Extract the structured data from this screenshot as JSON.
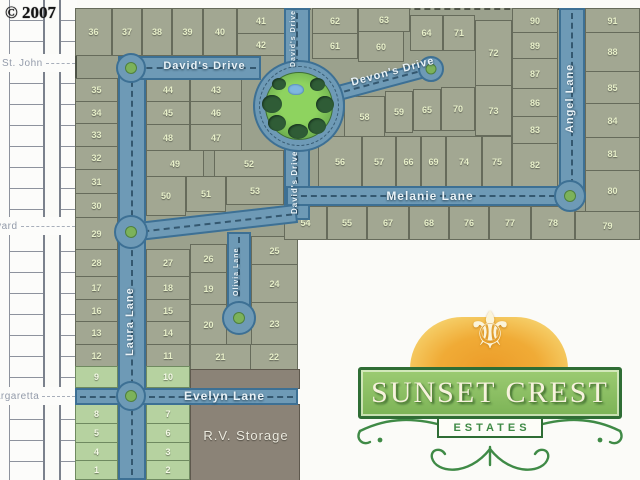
{
  "copyright": "© 2007",
  "logo": {
    "title": "SUNSET CREST",
    "subtitle": "ESTATES"
  },
  "map": {
    "rv_storage": "R.V. Storage",
    "offsite_streets": [
      {
        "name": "St. John",
        "x": 2,
        "y": 63
      },
      {
        "name": "Boulevard",
        "x": -32,
        "y": 226
      },
      {
        "name": "Margaretta",
        "x": -14,
        "y": 396
      }
    ],
    "street_labels": [
      {
        "text": "David's Drive",
        "kind": "h",
        "x": 152,
        "y": 60,
        "w": 105,
        "size": 11
      },
      {
        "text": "David's Drive",
        "kind": "v",
        "x": 290,
        "y": 10,
        "h": 56,
        "size": 7
      },
      {
        "text": "David's Drive",
        "kind": "v",
        "x": 290,
        "y": 146,
        "h": 72,
        "size": 8
      },
      {
        "text": "Devon's Drive",
        "kind": "r",
        "x": 347,
        "y": 78,
        "w": 95,
        "size": 11,
        "deg": -15
      },
      {
        "text": "Melanie Lane",
        "kind": "h",
        "x": 340,
        "y": 189,
        "w": 180,
        "size": 12
      },
      {
        "text": "Angel Lane",
        "kind": "v",
        "x": 564,
        "y": 48,
        "h": 100,
        "size": 11
      },
      {
        "text": "Laura Lane",
        "kind": "v",
        "x": 124,
        "y": 268,
        "h": 108,
        "size": 11
      },
      {
        "text": "Olivia Lane",
        "kind": "v",
        "x": 233,
        "y": 241,
        "h": 62,
        "size": 7
      },
      {
        "text": "Evelyn Lane",
        "kind": "h",
        "x": 162,
        "y": 389,
        "w": 125,
        "size": 12
      }
    ],
    "lots": [
      {
        "n": "36",
        "x": 75,
        "y": 8,
        "w": 37,
        "h": 48
      },
      {
        "n": "37",
        "x": 112,
        "y": 8,
        "w": 30,
        "h": 48
      },
      {
        "n": "38",
        "x": 142,
        "y": 8,
        "w": 30,
        "h": 48
      },
      {
        "n": "39",
        "x": 172,
        "y": 8,
        "w": 31,
        "h": 48
      },
      {
        "n": "40",
        "x": 203,
        "y": 8,
        "w": 34,
        "h": 48
      },
      {
        "n": "41",
        "x": 237,
        "y": 8,
        "w": 48,
        "h": 26
      },
      {
        "n": "42",
        "x": 237,
        "y": 33,
        "w": 48,
        "h": 23
      },
      {
        "n": "35",
        "x": 75,
        "y": 78,
        "w": 43,
        "h": 24
      },
      {
        "n": "34",
        "x": 75,
        "y": 101,
        "w": 43,
        "h": 23
      },
      {
        "n": "33",
        "x": 75,
        "y": 123,
        "w": 43,
        "h": 24
      },
      {
        "n": "32",
        "x": 75,
        "y": 146,
        "w": 43,
        "h": 24
      },
      {
        "n": "31",
        "x": 75,
        "y": 169,
        "w": 43,
        "h": 25
      },
      {
        "n": "30",
        "x": 75,
        "y": 193,
        "w": 43,
        "h": 25
      },
      {
        "n": "29",
        "x": 75,
        "y": 217,
        "w": 43,
        "h": 33
      },
      {
        "n": "28",
        "x": 75,
        "y": 249,
        "w": 43,
        "h": 28
      },
      {
        "n": "17",
        "x": 75,
        "y": 276,
        "w": 43,
        "h": 24
      },
      {
        "n": "16",
        "x": 75,
        "y": 299,
        "w": 43,
        "h": 23
      },
      {
        "n": "13",
        "x": 75,
        "y": 321,
        "w": 43,
        "h": 24
      },
      {
        "n": "12",
        "x": 75,
        "y": 344,
        "w": 43,
        "h": 23
      },
      {
        "n": "9",
        "x": 75,
        "y": 366,
        "w": 43,
        "h": 22,
        "g": true
      },
      {
        "n": "8",
        "x": 75,
        "y": 403,
        "w": 43,
        "h": 21,
        "g": true
      },
      {
        "n": "5",
        "x": 75,
        "y": 423,
        "w": 43,
        "h": 20,
        "g": true
      },
      {
        "n": "4",
        "x": 75,
        "y": 442,
        "w": 43,
        "h": 19,
        "g": true
      },
      {
        "n": "1",
        "x": 75,
        "y": 460,
        "w": 43,
        "h": 20,
        "g": true
      },
      {
        "n": "27",
        "x": 146,
        "y": 249,
        "w": 44,
        "h": 28
      },
      {
        "n": "18",
        "x": 146,
        "y": 276,
        "w": 44,
        "h": 24
      },
      {
        "n": "15",
        "x": 146,
        "y": 299,
        "w": 44,
        "h": 23
      },
      {
        "n": "14",
        "x": 146,
        "y": 321,
        "w": 44,
        "h": 24
      },
      {
        "n": "11",
        "x": 146,
        "y": 344,
        "w": 44,
        "h": 23
      },
      {
        "n": "10",
        "x": 146,
        "y": 366,
        "w": 44,
        "h": 22,
        "g": true
      },
      {
        "n": "7",
        "x": 146,
        "y": 403,
        "w": 44,
        "h": 21,
        "g": true
      },
      {
        "n": "6",
        "x": 146,
        "y": 423,
        "w": 44,
        "h": 20,
        "g": true
      },
      {
        "n": "3",
        "x": 146,
        "y": 442,
        "w": 44,
        "h": 19,
        "g": true
      },
      {
        "n": "2",
        "x": 146,
        "y": 460,
        "w": 44,
        "h": 20,
        "g": true
      },
      {
        "n": "26",
        "x": 190,
        "y": 244,
        "w": 37,
        "h": 29
      },
      {
        "n": "19",
        "x": 190,
        "y": 272,
        "w": 37,
        "h": 33
      },
      {
        "n": "20",
        "x": 190,
        "y": 304,
        "w": 37,
        "h": 41
      },
      {
        "n": "21",
        "x": 190,
        "y": 344,
        "w": 61,
        "h": 26
      },
      {
        "n": "25",
        "x": 251,
        "y": 236,
        "w": 47,
        "h": 29
      },
      {
        "n": "24",
        "x": 251,
        "y": 264,
        "w": 47,
        "h": 39
      },
      {
        "n": "23",
        "x": 251,
        "y": 302,
        "w": 47,
        "h": 43
      },
      {
        "n": "22",
        "x": 250,
        "y": 344,
        "w": 48,
        "h": 26
      },
      {
        "n": "44",
        "x": 146,
        "y": 78,
        "w": 44,
        "h": 24
      },
      {
        "n": "43",
        "x": 190,
        "y": 78,
        "w": 52,
        "h": 24
      },
      {
        "n": "45",
        "x": 146,
        "y": 101,
        "w": 44,
        "h": 24
      },
      {
        "n": "46",
        "x": 190,
        "y": 101,
        "w": 52,
        "h": 24
      },
      {
        "n": "48",
        "x": 146,
        "y": 124,
        "w": 44,
        "h": 27
      },
      {
        "n": "47",
        "x": 190,
        "y": 124,
        "w": 52,
        "h": 27
      },
      {
        "n": "49",
        "x": 146,
        "y": 150,
        "w": 58,
        "h": 27
      },
      {
        "n": "52",
        "x": 214,
        "y": 150,
        "w": 70,
        "h": 27
      },
      {
        "n": "50",
        "x": 146,
        "y": 176,
        "w": 40,
        "h": 40
      },
      {
        "n": "51",
        "x": 186,
        "y": 176,
        "w": 40,
        "h": 36
      },
      {
        "n": "53",
        "x": 226,
        "y": 176,
        "w": 58,
        "h": 29
      },
      {
        "n": "62",
        "x": 312,
        "y": 8,
        "w": 46,
        "h": 26
      },
      {
        "n": "63",
        "x": 358,
        "y": 8,
        "w": 52,
        "h": 24
      },
      {
        "n": "61",
        "x": 312,
        "y": 33,
        "w": 46,
        "h": 26
      },
      {
        "n": "60",
        "x": 358,
        "y": 31,
        "w": 46,
        "h": 31
      },
      {
        "n": "64",
        "x": 410,
        "y": 15,
        "w": 33,
        "h": 36
      },
      {
        "n": "71",
        "x": 443,
        "y": 15,
        "w": 32,
        "h": 36
      },
      {
        "n": "72",
        "x": 475,
        "y": 20,
        "w": 37,
        "h": 66
      },
      {
        "n": "73",
        "x": 475,
        "y": 85,
        "w": 37,
        "h": 51
      },
      {
        "n": "58",
        "x": 344,
        "y": 96,
        "w": 41,
        "h": 41
      },
      {
        "n": "59",
        "x": 385,
        "y": 91,
        "w": 28,
        "h": 42
      },
      {
        "n": "65",
        "x": 413,
        "y": 89,
        "w": 28,
        "h": 42
      },
      {
        "n": "70",
        "x": 441,
        "y": 87,
        "w": 34,
        "h": 44
      },
      {
        "n": "56",
        "x": 318,
        "y": 136,
        "w": 44,
        "h": 51
      },
      {
        "n": "57",
        "x": 362,
        "y": 136,
        "w": 34,
        "h": 51
      },
      {
        "n": "66",
        "x": 396,
        "y": 136,
        "w": 25,
        "h": 51
      },
      {
        "n": "69",
        "x": 421,
        "y": 136,
        "w": 25,
        "h": 51
      },
      {
        "n": "74",
        "x": 446,
        "y": 136,
        "w": 36,
        "h": 51
      },
      {
        "n": "75",
        "x": 482,
        "y": 136,
        "w": 30,
        "h": 51
      },
      {
        "n": "90",
        "x": 512,
        "y": 8,
        "w": 46,
        "h": 25
      },
      {
        "n": "89",
        "x": 512,
        "y": 32,
        "w": 46,
        "h": 27
      },
      {
        "n": "87",
        "x": 512,
        "y": 58,
        "w": 46,
        "h": 31
      },
      {
        "n": "86",
        "x": 512,
        "y": 88,
        "w": 46,
        "h": 29
      },
      {
        "n": "83",
        "x": 512,
        "y": 116,
        "w": 46,
        "h": 28
      },
      {
        "n": "82",
        "x": 512,
        "y": 143,
        "w": 46,
        "h": 44
      },
      {
        "n": "91",
        "x": 585,
        "y": 8,
        "w": 55,
        "h": 25
      },
      {
        "n": "88",
        "x": 585,
        "y": 32,
        "w": 55,
        "h": 40
      },
      {
        "n": "85",
        "x": 585,
        "y": 71,
        "w": 55,
        "h": 33
      },
      {
        "n": "84",
        "x": 585,
        "y": 103,
        "w": 55,
        "h": 35
      },
      {
        "n": "81",
        "x": 585,
        "y": 137,
        "w": 55,
        "h": 34
      },
      {
        "n": "80",
        "x": 585,
        "y": 170,
        "w": 55,
        "h": 42
      },
      {
        "n": "54",
        "x": 284,
        "y": 206,
        "w": 43,
        "h": 34
      },
      {
        "n": "55",
        "x": 327,
        "y": 206,
        "w": 40,
        "h": 34
      },
      {
        "n": "67",
        "x": 367,
        "y": 206,
        "w": 42,
        "h": 34
      },
      {
        "n": "68",
        "x": 409,
        "y": 206,
        "w": 40,
        "h": 34
      },
      {
        "n": "76",
        "x": 449,
        "y": 206,
        "w": 40,
        "h": 34
      },
      {
        "n": "77",
        "x": 489,
        "y": 206,
        "w": 42,
        "h": 34
      },
      {
        "n": "78",
        "x": 531,
        "y": 206,
        "w": 44,
        "h": 34
      },
      {
        "n": "79",
        "x": 575,
        "y": 211,
        "w": 65,
        "h": 29
      }
    ]
  },
  "colors": {
    "road": "#6e9ab6",
    "road_edge": "#3d7094",
    "lot_fill": "#a2a792",
    "lot_available": "#b6d2a0",
    "park_lawn": "#8ed35f",
    "storage": "#8b8377",
    "logo_green": "#8cc063",
    "logo_sun": "#f0ab36"
  }
}
